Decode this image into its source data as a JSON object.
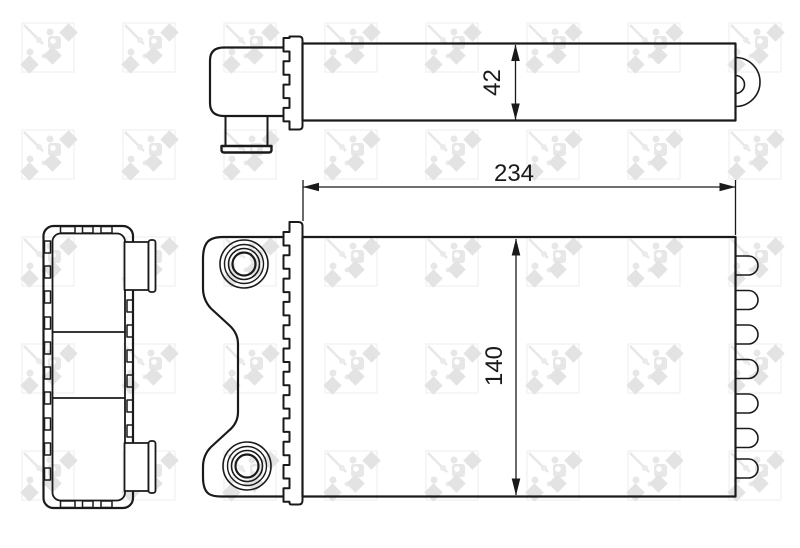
{
  "watermark": {
    "brand": "NRF"
  },
  "drawing": {
    "dimensions": {
      "depth": {
        "value": "42"
      },
      "width": {
        "value": "234"
      },
      "height": {
        "value": "140"
      }
    },
    "colors": {
      "line": "#1a1a1a",
      "background": "#ffffff",
      "watermark_shape": "#e3e3e3",
      "watermark_frame": "#f0f0f0"
    }
  }
}
